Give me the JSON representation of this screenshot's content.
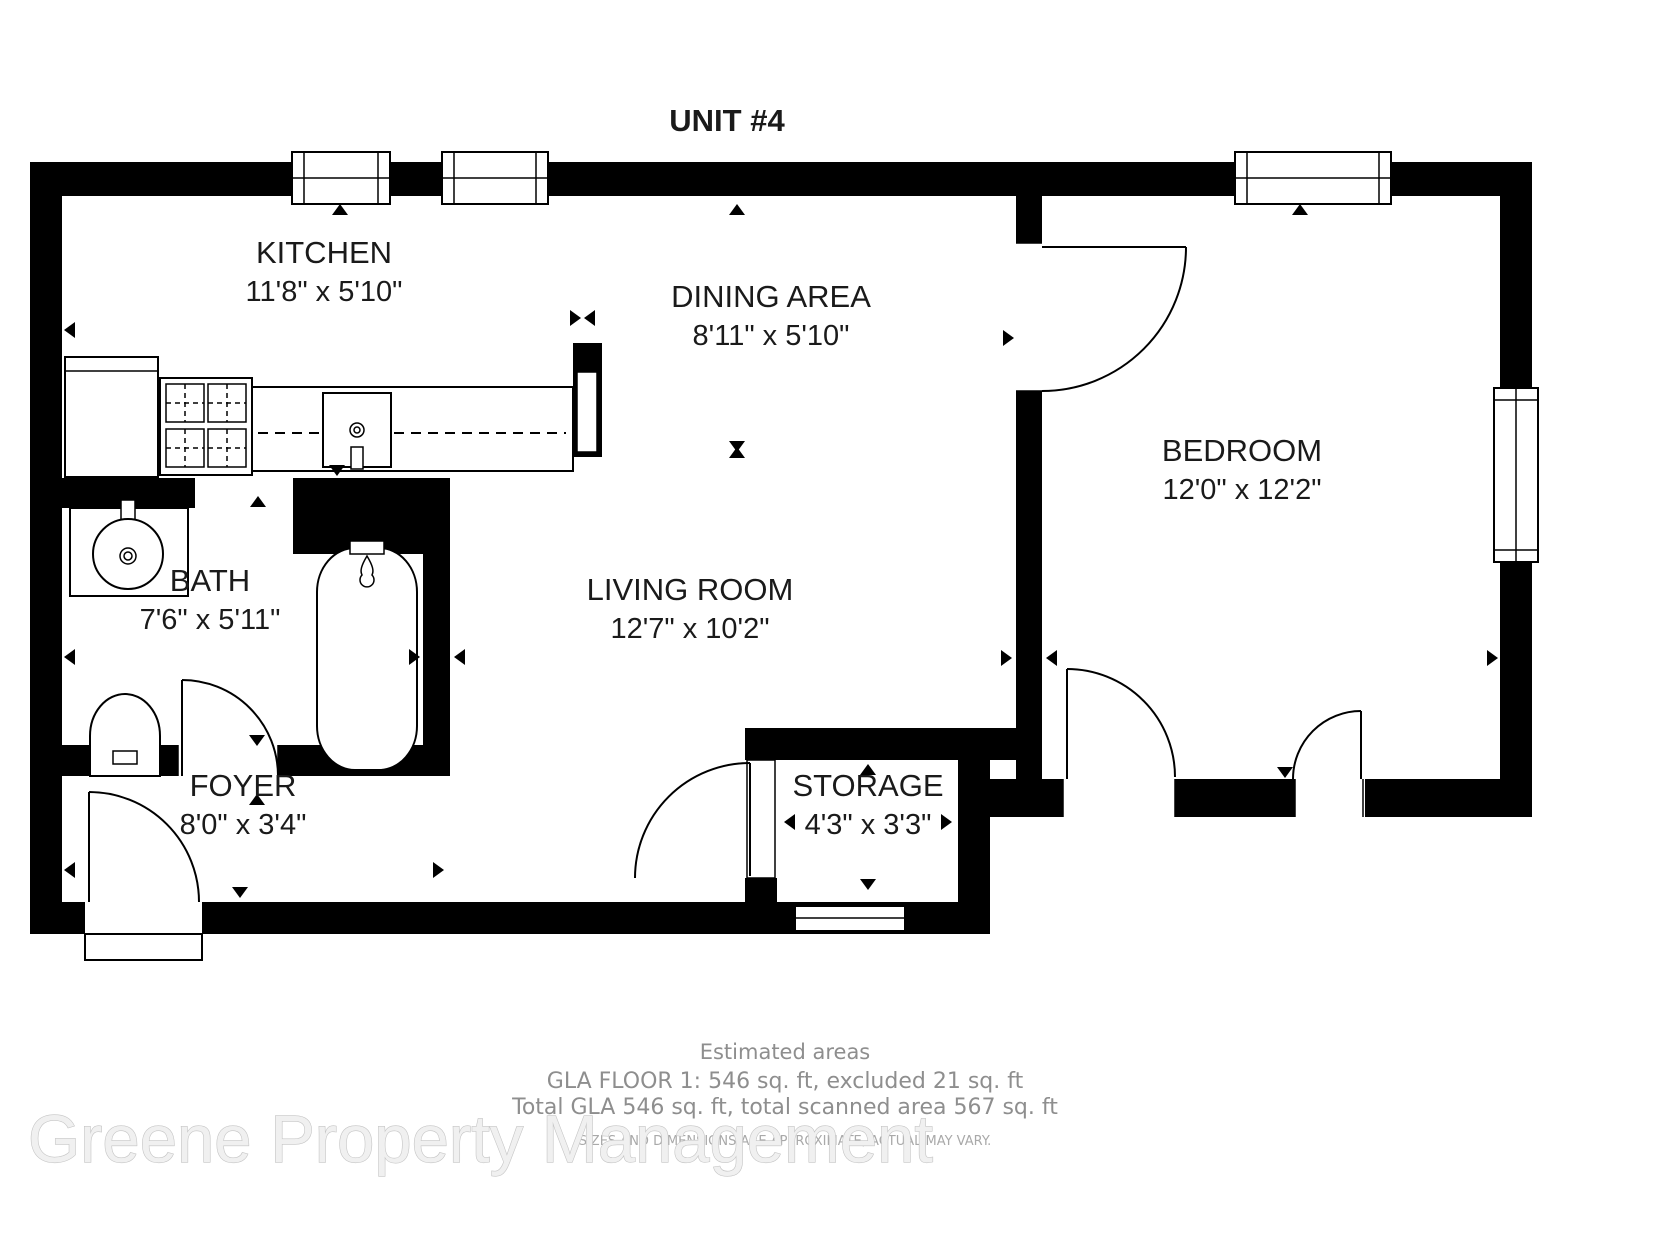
{
  "title": "UNIT #4",
  "rooms": {
    "kitchen": {
      "name": "KITCHEN",
      "dims": "11'8\" x 5'10\""
    },
    "dining": {
      "name": "DINING AREA",
      "dims": "8'11\" x 5'10\""
    },
    "bedroom": {
      "name": "BEDROOM",
      "dims": "12'0\" x 12'2\""
    },
    "bath": {
      "name": "BATH",
      "dims": "7'6\" x 5'11\""
    },
    "living": {
      "name": "LIVING ROOM",
      "dims": "12'7\" x 10'2\""
    },
    "foyer": {
      "name": "FOYER",
      "dims": "8'0\" x 3'4\""
    },
    "storage": {
      "name": "STORAGE",
      "dims": "4'3\" x 3'3\""
    }
  },
  "footer": {
    "heading": "Estimated areas",
    "line1": "GLA FLOOR 1: 546 sq. ft, excluded 21 sq. ft",
    "line2": "Total GLA 546 sq. ft, total scanned area 567 sq. ft",
    "disclaimer": "SIZES AND DIMENSIONS ARE APPROXIMATE, ACTUAL MAY VARY."
  },
  "watermark": "Greene Property Management",
  "colors": {
    "walls": "#000000",
    "footer_text": "#8e8e8e",
    "disclaimer_text": "#a9a9a9",
    "watermark_fill": "#f0f0f0",
    "watermark_outline": "#c4c4c4"
  }
}
